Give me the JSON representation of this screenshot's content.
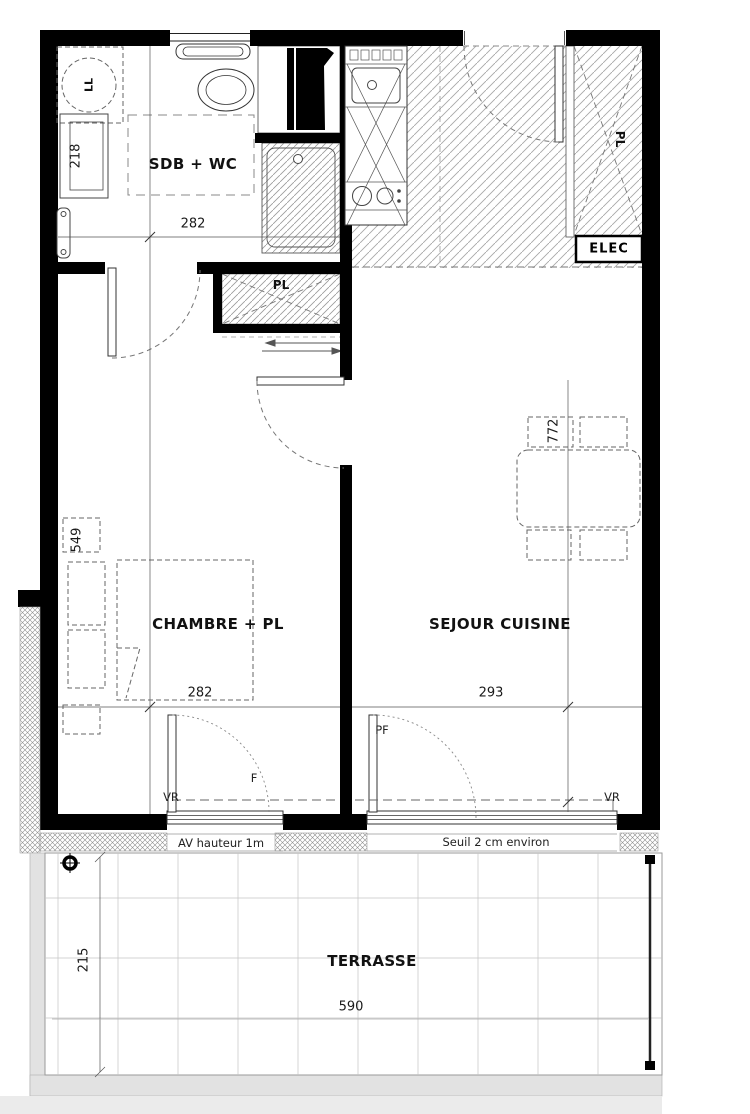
{
  "colors": {
    "wall": "#000000",
    "hatch_line": "#9f9f9f",
    "dash_line": "#666666",
    "dim_line": "#555555",
    "slab_gray": "#e2e2e2"
  },
  "rooms": {
    "sdb_wc": {
      "label": "SDB + WC",
      "width": "282"
    },
    "chambre": {
      "label": "CHAMBRE + PL",
      "width": "282",
      "length": "549"
    },
    "sejour": {
      "label": "SEJOUR CUISINE",
      "width": "293",
      "length": "772"
    },
    "terrasse": {
      "label": "TERRASSE",
      "width": "590",
      "depth": "215"
    }
  },
  "closets": {
    "hall": "PL",
    "entry": "PL"
  },
  "boxes": {
    "elec": "ELEC"
  },
  "appliances": {
    "washing_machine": "LL",
    "bathroom_dim": "218"
  },
  "openings": {
    "bedroom_window": "F",
    "terrace_door": "PF",
    "shutter_left": "VR",
    "shutter_right": "VR"
  },
  "notes": {
    "window_height": "AV hauteur 1m",
    "threshold": "Seuil 2 cm environ"
  }
}
